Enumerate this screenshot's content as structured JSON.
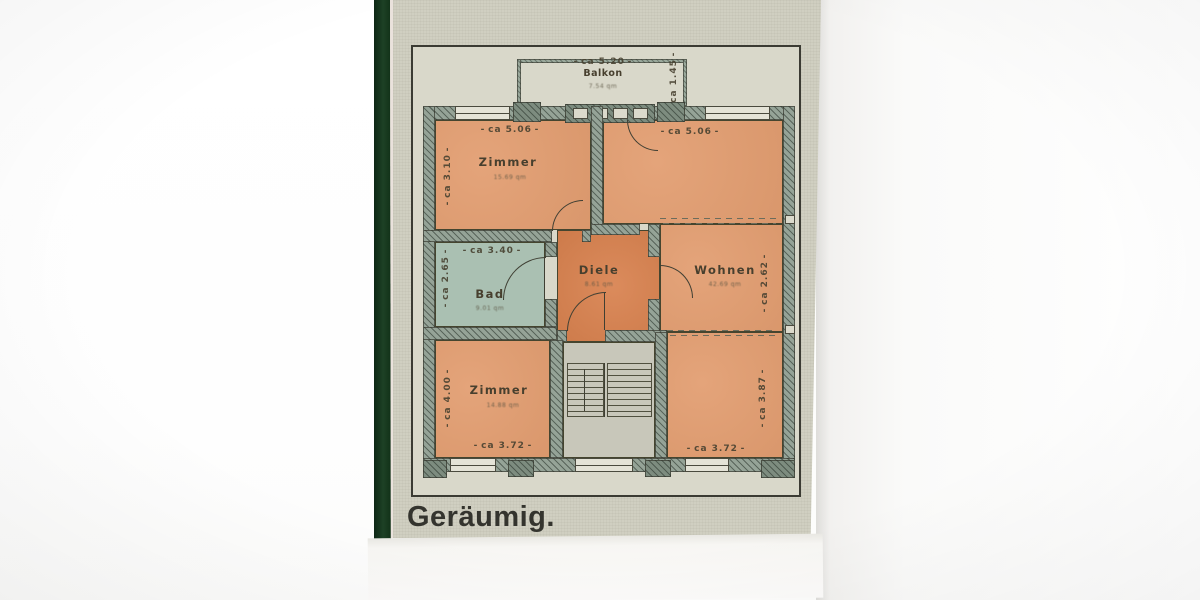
{
  "headline": "Geräumig.",
  "plan": {
    "balkon": {
      "label": "Balkon",
      "area": "7.54 qm",
      "dim_width": "ca 5.20",
      "dim_depth": "ca 1.45"
    },
    "zimmer_nw": {
      "label": "Zimmer",
      "area": "15.69 qm",
      "dim_width": "ca 5.06",
      "dim_height": "ca 3.10"
    },
    "wohnen_ne": {
      "dim_width": "ca 5.06"
    },
    "bad": {
      "label": "Bad",
      "area": "9.01 qm",
      "dim_width": "ca 3.40",
      "dim_height": "ca 2.65"
    },
    "diele": {
      "label": "Diele",
      "area": "8.61 qm"
    },
    "wohnen": {
      "label": "Wohnen",
      "area": "42.69 qm",
      "dim_height": "ca 2.62"
    },
    "zimmer_sw": {
      "label": "Zimmer",
      "area": "14.88 qm",
      "dim_height": "ca 4.00",
      "dim_width": "ca 3.72"
    },
    "wohnen_se": {
      "dim_height": "ca 3.87",
      "dim_width": "ca 3.72"
    }
  },
  "colors": {
    "room_orange": "#e29d70",
    "hall_orange": "#d8814e",
    "bath_green": "#aac0b2",
    "wall_green_gray": "#95a397",
    "newsprint": "#d0cfc1",
    "ink": "#3b3b33",
    "green_strip": "#1d4125"
  }
}
